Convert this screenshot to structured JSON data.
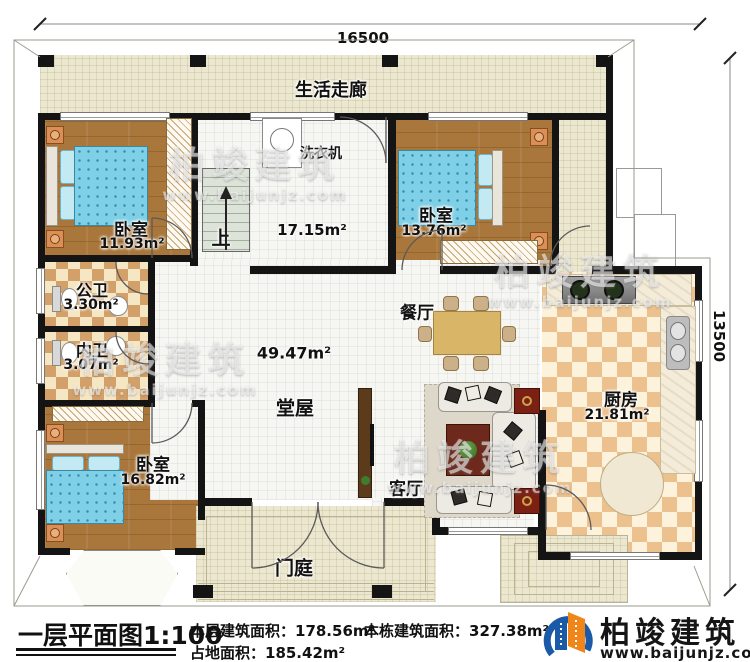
{
  "dimensions": {
    "top": "16500",
    "right": "13500"
  },
  "plan": {
    "corridor": {
      "label": "生活走廊"
    },
    "bedroom_tl": {
      "label": "卧室",
      "area": "11.93m²"
    },
    "utility": {
      "washer_label": "洗衣机",
      "area": "17.15m²",
      "up_label": "上"
    },
    "bedroom_tr": {
      "label": "卧室",
      "area": "13.76m²"
    },
    "bath_public": {
      "label": "公卫",
      "area": "3.30m²"
    },
    "bath_ensuite": {
      "label": "内卫",
      "area": "3.07m²"
    },
    "hall": {
      "label": "堂屋",
      "area": "49.47m²"
    },
    "dining": {
      "label": "餐厅"
    },
    "kitchen": {
      "label": "厨房",
      "area": "21.81m²"
    },
    "living": {
      "label": "客厅"
    },
    "bedroom_bl": {
      "label": "卧室",
      "area": "16.82m²"
    },
    "porch": {
      "label": "门庭"
    }
  },
  "title_block": {
    "title": "一层平面图1:100",
    "floor_area": "本层建筑面积：178.56m²",
    "building_area": "本栋建筑面积：327.38m²",
    "footprint_area": "占地面积：185.42m²"
  },
  "branding": {
    "company": "柏竣建筑",
    "website": "www.baijunjz.com"
  },
  "watermark": {
    "text": "柏竣建筑",
    "site": "www.baijunjz.com"
  },
  "colors": {
    "wall": "#141414",
    "wood": "#a9773c",
    "tile": "#ece7cf",
    "bed_blue": "#7fd0e6",
    "logo_blue": "#1a5aa6",
    "logo_orange": "#f08519"
  }
}
